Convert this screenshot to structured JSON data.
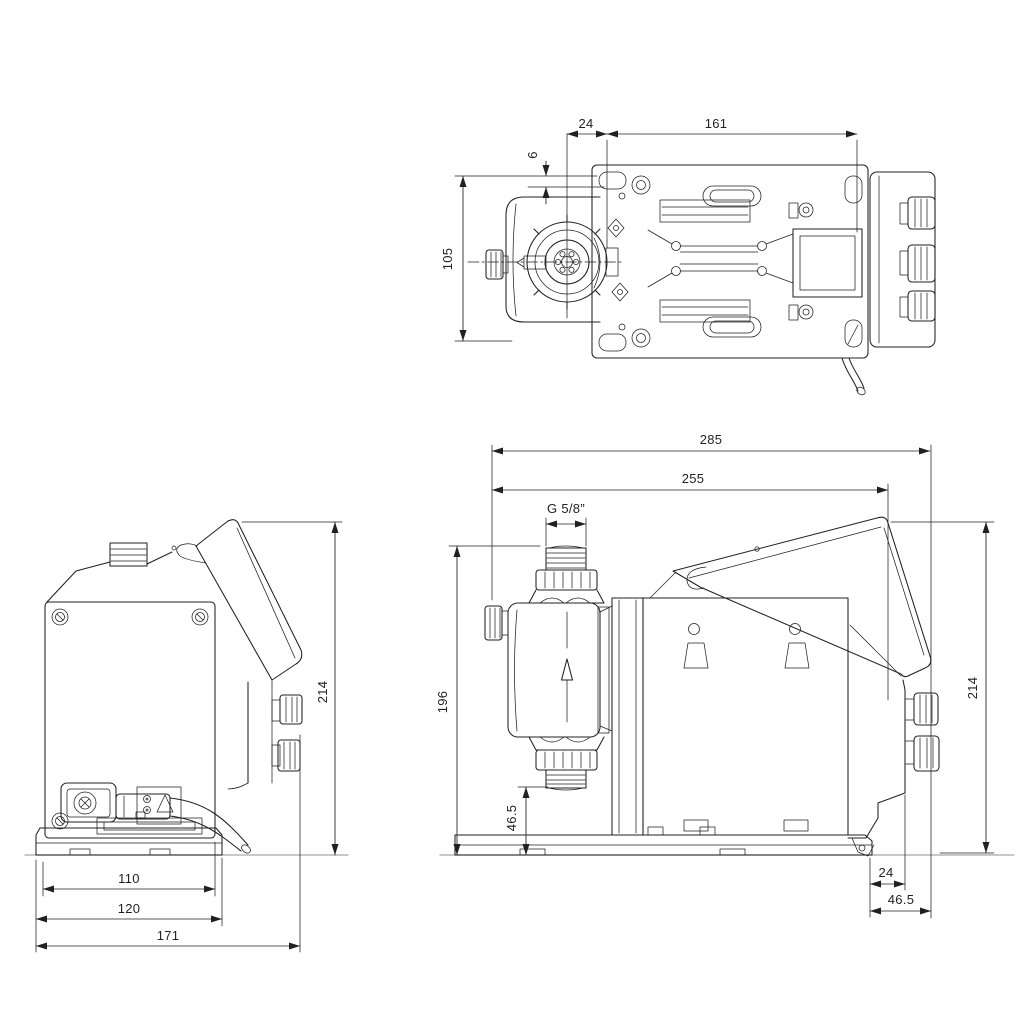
{
  "canvas": {
    "background": "#ffffff",
    "line_color": "#202020",
    "dim_text_color": "#1f2023",
    "ground_line_color": "#a6a6a6"
  },
  "views": {
    "top": {
      "dims": {
        "d24": "24",
        "d161": "161",
        "d6": "6",
        "d105": "105"
      }
    },
    "rear": {
      "dims": {
        "d214": "214",
        "d110": "110",
        "d120": "120",
        "d171": "171"
      }
    },
    "side": {
      "dims": {
        "d285": "285",
        "d255": "255",
        "thread": "G 5/8”",
        "d196": "196",
        "d46_5_valve": "46.5",
        "d214": "214",
        "d24": "24",
        "d46_5_rear": "46.5"
      }
    }
  }
}
